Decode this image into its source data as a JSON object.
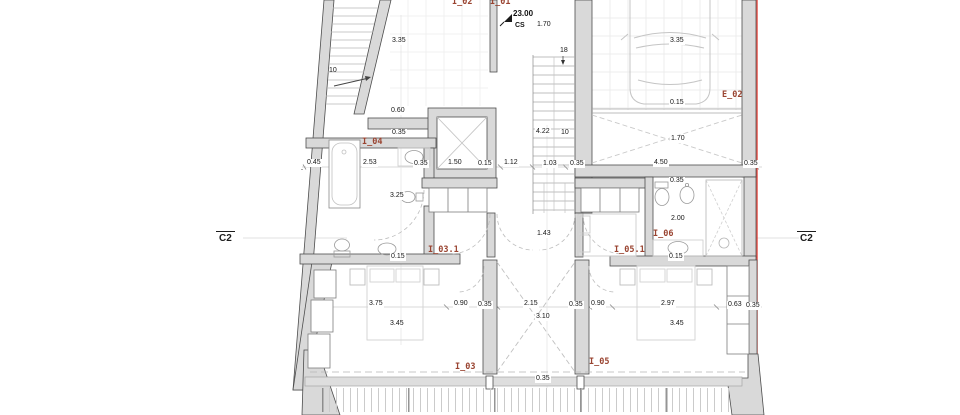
{
  "title": "floor plan level 23.00",
  "section_markers": {
    "left": "C2",
    "right": "C2"
  },
  "level_marker": {
    "value": "23.00",
    "code": "CS"
  },
  "room_labels": [
    {
      "t": "I_02"
    },
    {
      "t": "I_01"
    },
    {
      "t": "E_02"
    },
    {
      "t": "I_04"
    },
    {
      "t": "I_03.1"
    },
    {
      "t": "I_06"
    },
    {
      "t": "I_05.1"
    },
    {
      "t": "I_03"
    },
    {
      "t": "I_05"
    }
  ],
  "dims": [
    {
      "t": "3.35"
    },
    {
      "t": "10"
    },
    {
      "t": "1.70"
    },
    {
      "t": "18"
    },
    {
      "t": "3.35"
    },
    {
      "t": "0.15"
    },
    {
      "t": "0.60"
    },
    {
      "t": "0.35"
    },
    {
      "t": "4.22"
    },
    {
      "t": "10"
    },
    {
      "t": "1.70"
    },
    {
      "t": "0.45"
    },
    {
      "t": "2.53"
    },
    {
      "t": "0.35"
    },
    {
      "t": "1.50"
    },
    {
      "t": "0.15"
    },
    {
      "t": "1.12"
    },
    {
      "t": "1.03"
    },
    {
      "t": "0.35"
    },
    {
      "t": "4.50"
    },
    {
      "t": "0.35"
    },
    {
      "t": "0.35"
    },
    {
      "t": "3.25"
    },
    {
      "t": "2.00"
    },
    {
      "t": "1.43"
    },
    {
      "t": "0.15"
    },
    {
      "t": "0.15"
    },
    {
      "t": "3.75"
    },
    {
      "t": "0.90"
    },
    {
      "t": "0.35"
    },
    {
      "t": "2.15"
    },
    {
      "t": "0.35"
    },
    {
      "t": "0.90"
    },
    {
      "t": "2.97"
    },
    {
      "t": "0.63"
    },
    {
      "t": "0.35"
    },
    {
      "t": "3.45"
    },
    {
      "t": "3.10"
    },
    {
      "t": "3.45"
    },
    {
      "t": "0.35"
    }
  ],
  "colors": {
    "wall_fill": "#d9d9d9",
    "wall_stroke": "#4d4d4d",
    "property_line": "#e8463e",
    "room_label": "#9a4431",
    "dim_text": "#151515",
    "fixture": "#9a9a9a"
  }
}
